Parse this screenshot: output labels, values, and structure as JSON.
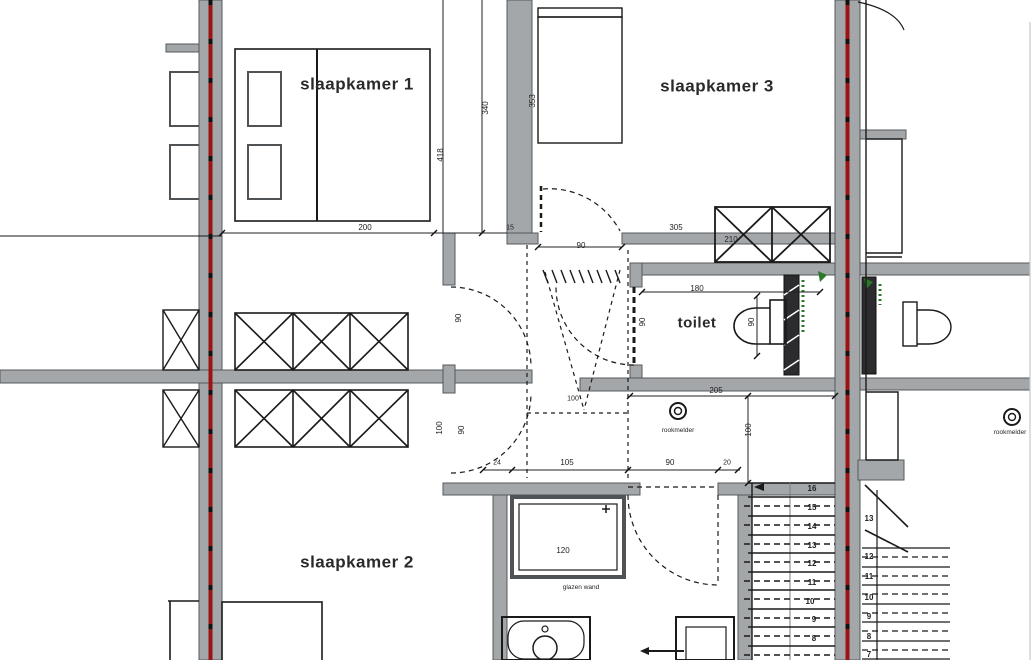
{
  "title": "verdieping plattegrond",
  "colors": {
    "wall_fill": "#a4a7aa",
    "wall_stroke": "#55585b",
    "party_wall_line": "#9b1313",
    "drawing_line": "#1a1a1a",
    "green_annotation": "#2b7a2b"
  },
  "rooms": [
    {
      "name": "room-label-slaapkamer-1",
      "text": "slaapkamer 1",
      "x": 357,
      "y": 84,
      "size": 17
    },
    {
      "name": "room-label-slaapkamer-3",
      "text": "slaapkamer 3",
      "x": 717,
      "y": 86,
      "size": 17
    },
    {
      "name": "room-label-slaapkamer-2",
      "text": "slaapkamer 2",
      "x": 357,
      "y": 562,
      "size": 17
    },
    {
      "name": "room-label-toilet",
      "text": "toilet",
      "x": 697,
      "y": 323,
      "size": 15
    }
  ],
  "annotations": [
    {
      "name": "rookmelder-label",
      "text": "rookmelder",
      "x": 678,
      "y": 431,
      "size": 6.5
    },
    {
      "name": "glazen-wand-label",
      "text": "glazen wand",
      "x": 581,
      "y": 588,
      "size": 6.5
    },
    {
      "name": "neighbor-rookmelder-label",
      "text": "rookmelder",
      "x": 1010,
      "y": 433,
      "size": 6.5
    }
  ],
  "dimensions": [
    {
      "name": "dim-bed-200",
      "text": "200",
      "x": 365,
      "y": 228,
      "size": 8
    },
    {
      "name": "dim-wall-15",
      "text": "15",
      "x": 510,
      "y": 228,
      "size": 7
    },
    {
      "name": "dim-sk3-door-90",
      "text": "90",
      "x": 581,
      "y": 246,
      "size": 8
    },
    {
      "name": "dim-sk3-305",
      "text": "305",
      "x": 676,
      "y": 228,
      "size": 8
    },
    {
      "name": "dim-353",
      "text": "353",
      "x": 533,
      "y": 101,
      "size": 8,
      "rot": true
    },
    {
      "name": "dim-340",
      "text": "340",
      "x": 486,
      "y": 108,
      "size": 8,
      "rot": true
    },
    {
      "name": "dim-418",
      "text": "418",
      "x": 441,
      "y": 155,
      "size": 8,
      "rot": true
    },
    {
      "name": "dim-kast-210",
      "text": "210",
      "x": 731,
      "y": 240,
      "size": 8
    },
    {
      "name": "dim-toilet-180",
      "text": "180",
      "x": 697,
      "y": 289,
      "size": 8
    },
    {
      "name": "dim-toilet-90",
      "text": "90",
      "x": 752,
      "y": 322,
      "size": 8,
      "rot": true
    },
    {
      "name": "dim-toiletdoor-90",
      "text": "90",
      "x": 643,
      "y": 322,
      "size": 8,
      "rot": true
    },
    {
      "name": "dim-toilet-205",
      "text": "205",
      "x": 716,
      "y": 391,
      "size": 8
    },
    {
      "name": "dim-right-100",
      "text": "100",
      "x": 749,
      "y": 430,
      "size": 8,
      "rot": true
    },
    {
      "name": "dim-sk1-door-90",
      "text": "90",
      "x": 459,
      "y": 318,
      "size": 8,
      "rot": true
    },
    {
      "name": "dim-left-100",
      "text": "100",
      "x": 440,
      "y": 428,
      "size": 8,
      "rot": true
    },
    {
      "name": "dim-sk2-door-90",
      "text": "90",
      "x": 462,
      "y": 430,
      "size": 8,
      "rot": true
    },
    {
      "name": "dim-void-100",
      "text": "100",
      "x": 573,
      "y": 399,
      "size": 7
    },
    {
      "name": "dim-24",
      "text": "24",
      "x": 497,
      "y": 463,
      "size": 7
    },
    {
      "name": "dim-105",
      "text": "105",
      "x": 567,
      "y": 463,
      "size": 8
    },
    {
      "name": "dim-bath-door-90",
      "text": "90",
      "x": 670,
      "y": 463,
      "size": 8
    },
    {
      "name": "dim-20",
      "text": "20",
      "x": 727,
      "y": 463,
      "size": 7
    },
    {
      "name": "dim-douche-120",
      "text": "120",
      "x": 563,
      "y": 551,
      "size": 8
    }
  ],
  "stair_numbers_main": [
    {
      "n": "16",
      "x": 812,
      "y": 489
    },
    {
      "n": "15",
      "x": 812,
      "y": 508
    },
    {
      "n": "14",
      "x": 812,
      "y": 527
    },
    {
      "n": "13",
      "x": 812,
      "y": 546
    },
    {
      "n": "12",
      "x": 812,
      "y": 564
    },
    {
      "n": "11",
      "x": 812,
      "y": 583
    },
    {
      "n": "10",
      "x": 810,
      "y": 602
    },
    {
      "n": "9",
      "x": 814,
      "y": 620
    },
    {
      "n": "8",
      "x": 814,
      "y": 639
    }
  ],
  "stair_numbers_neighbor": [
    {
      "n": "13",
      "x": 869,
      "y": 519
    },
    {
      "n": "12",
      "x": 869,
      "y": 557
    },
    {
      "n": "11",
      "x": 869,
      "y": 577
    },
    {
      "n": "10",
      "x": 869,
      "y": 598
    },
    {
      "n": "9",
      "x": 869,
      "y": 617
    },
    {
      "n": "8",
      "x": 869,
      "y": 637
    },
    {
      "n": "7",
      "x": 869,
      "y": 655
    }
  ]
}
